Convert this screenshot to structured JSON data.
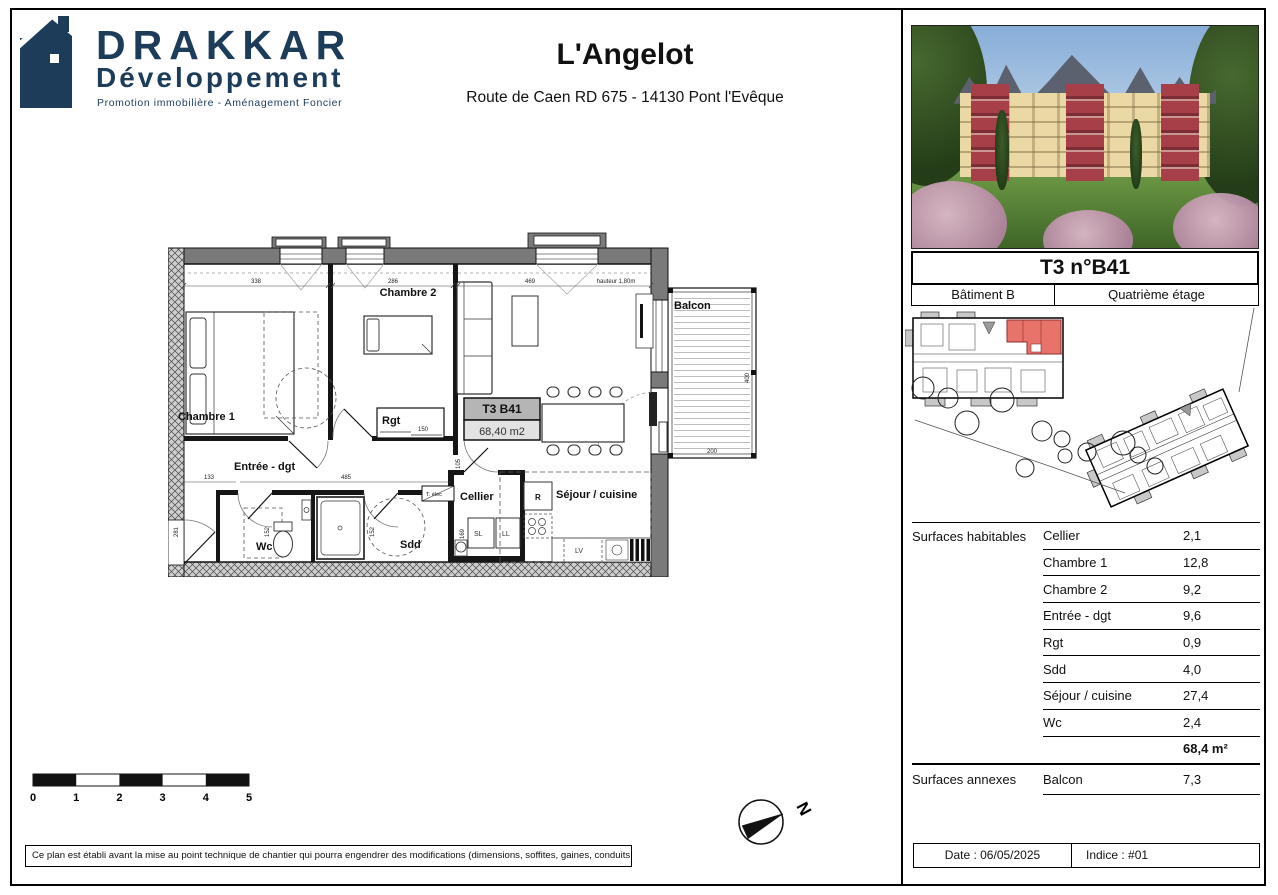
{
  "colors": {
    "brand_navy": "#1d3c5a",
    "highlight_red": "#e8736b",
    "plan_wall_gray": "#7a7a7a",
    "sejour_label_blue": "#223c6e"
  },
  "header": {
    "brand": "DRAKKAR",
    "brand_sub": "Développement",
    "tagline": "Promotion immobilière - Aménagement Foncier",
    "title": "L'Angelot",
    "address": "Route de Caen RD 675 - 14130 Pont l'Evêque"
  },
  "unit": {
    "title": "T3 n°B41",
    "building": "Bâtiment B",
    "floor": "Quatrième étage"
  },
  "plan": {
    "rooms": {
      "chambre1": "Chambre 1",
      "chambre2": "Chambre 2",
      "rgt": "Rgt",
      "entree": "Entrée - dgt",
      "wc": "Wc",
      "sdd": "Sdd",
      "cellier": "Cellier",
      "sejour": "Séjour / cuisine",
      "balcon": "Balcon"
    },
    "unit_box": {
      "line1": "T3 B41",
      "line2": "68,40 m2"
    },
    "appliances": {
      "telec": "T. élec",
      "fridge": "R",
      "sl": "SL",
      "ll": "LL",
      "lv": "LV"
    },
    "dims": {
      "w_chambre1": "338",
      "w_chambre2": "286",
      "w_sejour": "469",
      "hauteur": "hauteur 1,80m",
      "rgt": "150",
      "entree_a": "133",
      "entree_b": "485",
      "h_entree": "281",
      "h_wc": "152",
      "h_sdd": "152",
      "h_passage": "105",
      "h_cellier": "169",
      "balcon_h": "400",
      "balcon_w": "200"
    }
  },
  "surfaces": {
    "habitables_label": "Surfaces habitables",
    "annexes_label": "Surfaces annexes",
    "rows": [
      {
        "label": "Cellier",
        "value": "2,1"
      },
      {
        "label": "Chambre 1",
        "value": "12,8"
      },
      {
        "label": "Chambre 2",
        "value": "9,2"
      },
      {
        "label": "Entrée - dgt",
        "value": "9,6"
      },
      {
        "label": "Rgt",
        "value": "0,9"
      },
      {
        "label": "Sdd",
        "value": "4,0"
      },
      {
        "label": "Séjour / cuisine",
        "value": "27,4"
      },
      {
        "label": "Wc",
        "value": "2,4"
      }
    ],
    "total": "68,4 m²",
    "annexes": [
      {
        "label": "Balcon",
        "value": "7,3"
      }
    ]
  },
  "scalebar": {
    "t0": "0",
    "t1": "1",
    "t2": "2",
    "t3": "3",
    "t4": "4",
    "t5": "5"
  },
  "north": "N",
  "disclaimer": "Ce plan est établi avant la mise au point technique de chantier qui pourra engendrer des modifications (dimensions, soffites, gaines, conduits…)",
  "footer": {
    "date": "Date : 06/05/2025",
    "indice": "Indice : #01"
  }
}
